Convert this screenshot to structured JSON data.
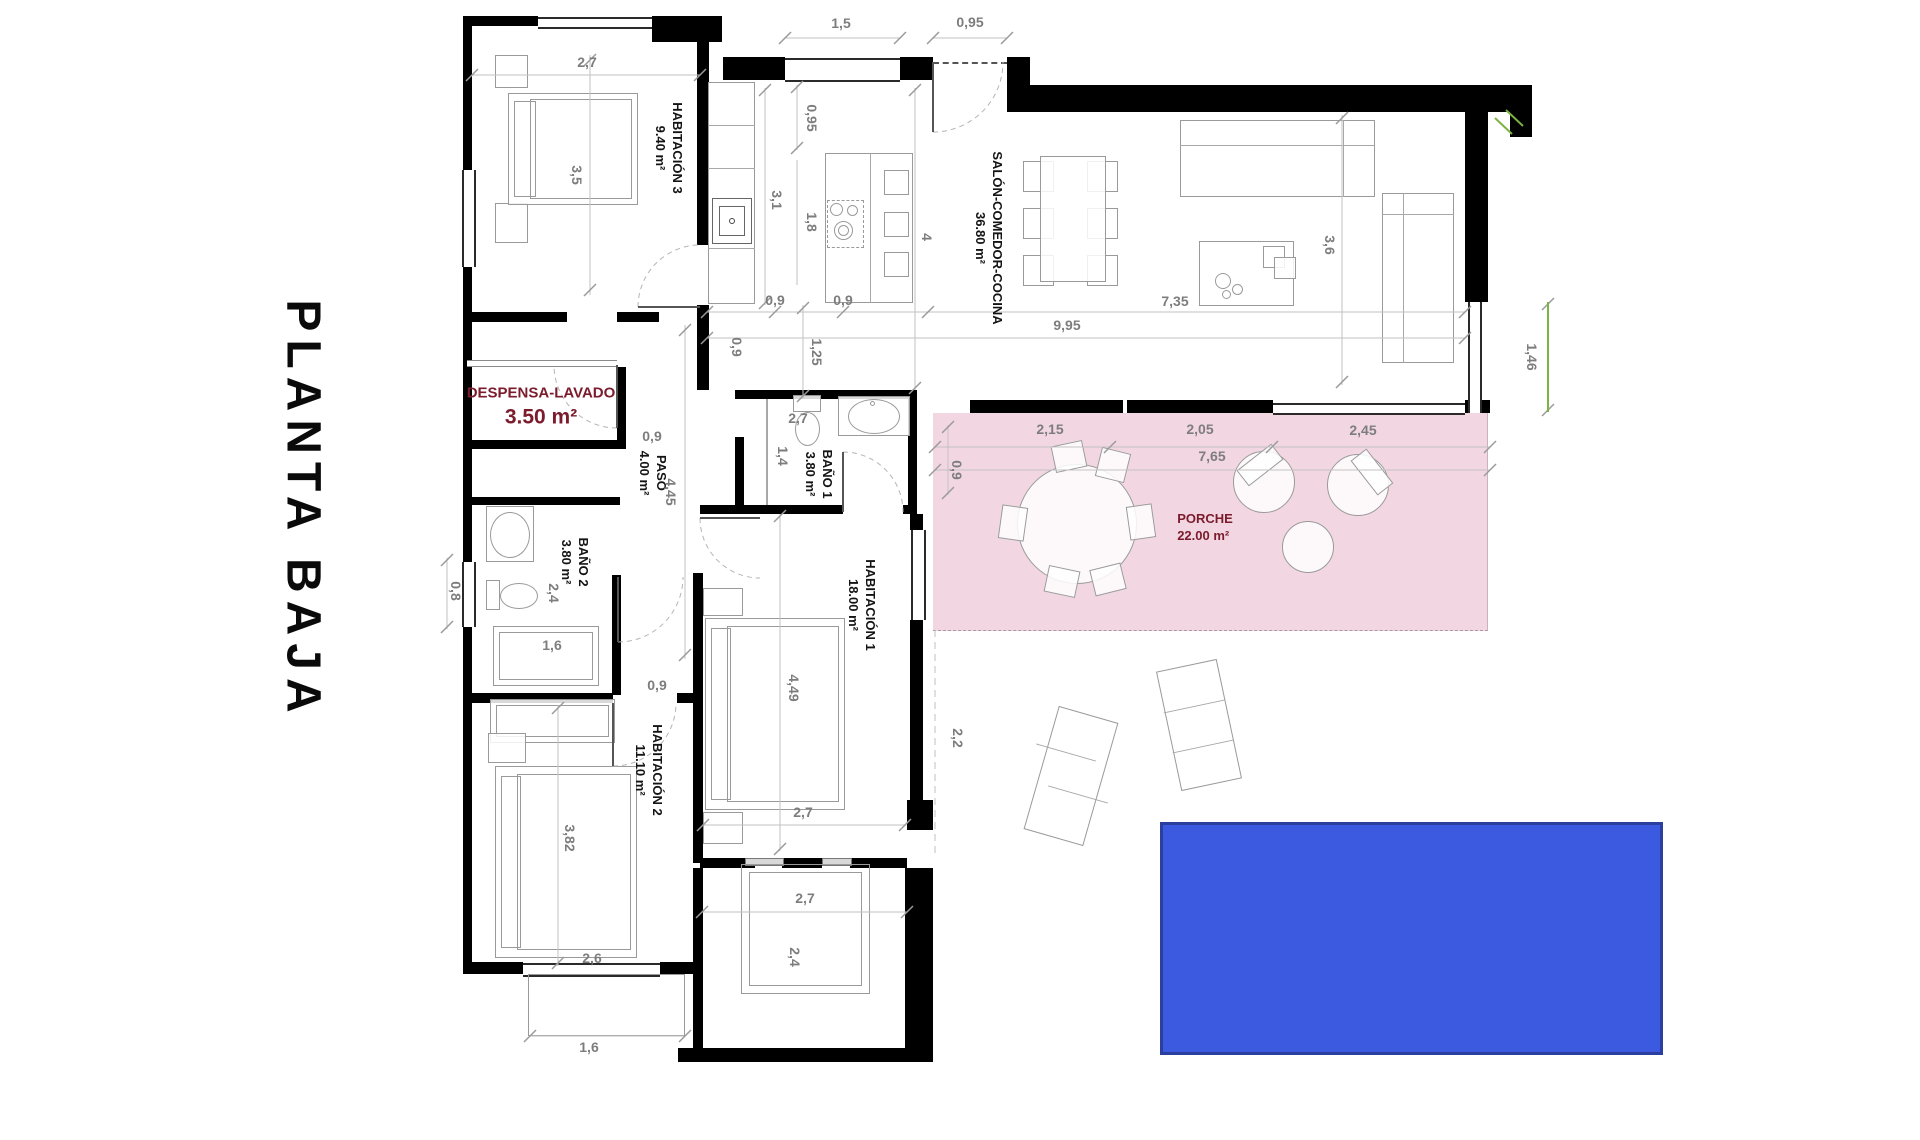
{
  "title": "PLANTA BAJA",
  "colors": {
    "porche_fill": "#f2d7e2",
    "pool_fill": "#3c5ae0",
    "pool_border": "#2b3f9e",
    "label_accent": "#7b1b2c"
  },
  "rooms": {
    "habitacion3": {
      "name": "HABITACIÓN 3",
      "area": "9.40 m²"
    },
    "salon": {
      "name": "SALÓN-COMEDOR-COCINA",
      "area": "36.80 m²"
    },
    "despensa": {
      "name": "DESPENSA-LAVADO",
      "area": "3.50 m²"
    },
    "paso": {
      "name": "PASO",
      "area": "4.00 m²"
    },
    "bano1": {
      "name": "BAÑO 1",
      "area": "3.80 m²"
    },
    "bano2": {
      "name": "BAÑO 2",
      "area": "3.80 m²"
    },
    "habitacion1": {
      "name": "HABITACIÓN 1",
      "area": "18.00 m²"
    },
    "habitacion2": {
      "name": "HABITACIÓN 2",
      "area": "11.10 m²"
    },
    "porche": {
      "name": "PORCHE",
      "area": "22.00 m²"
    }
  },
  "dims": {
    "top_27": "2,7",
    "hab3_35": "3,5",
    "top_15": "1,5",
    "top_095": "0,95",
    "k_095": "0,95",
    "k_31": "3,1",
    "k_18": "1,8",
    "k_4": "4",
    "k_09a": "0,9",
    "k_09b": "0,9",
    "k_09c": "0,9",
    "k_125": "1,25",
    "salon_995": "9,95",
    "salon_735": "7,35",
    "salon_36": "3,6",
    "right_146": "1,46",
    "despensa_09": "0,9",
    "paso_445": "4,45",
    "porche_09": "0,9",
    "porche_215": "2,15",
    "porche_205": "2,05",
    "porche_245": "2,45",
    "porche_765": "7,65",
    "bano1_27": "2,7",
    "bano1_14": "1,4",
    "bano2_08": "0,8",
    "bano2_24": "2,4",
    "bano2_16": "1,6",
    "hab2_09": "0,9",
    "hab1_449": "4,49",
    "hab1_27": "2,7",
    "right_22": "2,2",
    "hab2_382": "3,82",
    "hab2_26": "2,6",
    "broom_27": "2,7",
    "broom_24": "2,4",
    "bottom_16": "1,6"
  }
}
